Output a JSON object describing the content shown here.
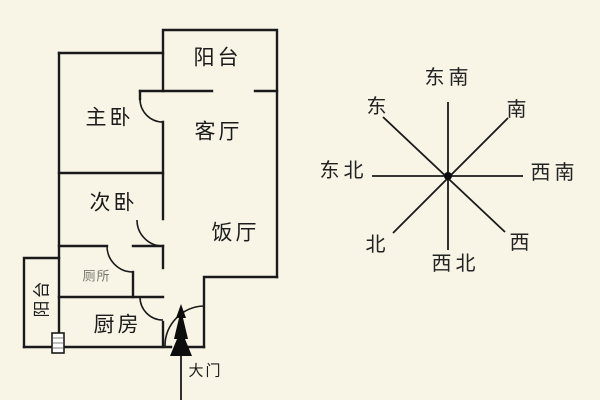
{
  "floor_plan": {
    "rooms": {
      "balcony_top": "阳台",
      "master_bedroom": "主卧",
      "living_room": "客厅",
      "second_bedroom": "次卧",
      "dining_room": "饭厅",
      "toilet": "厕所",
      "kitchen": "厨房",
      "balcony_left": "阳台",
      "main_door": "大门"
    }
  },
  "compass": {
    "directions": {
      "top": "东南",
      "upper_left": "东",
      "upper_right": "南",
      "left": "东北",
      "right": "西南",
      "lower_left": "北",
      "lower_right": "西",
      "bottom": "西北"
    }
  },
  "colors": {
    "background": "#F8F5E7",
    "wall_line": "#1a1a1a",
    "toilet_text": "#77776C"
  }
}
